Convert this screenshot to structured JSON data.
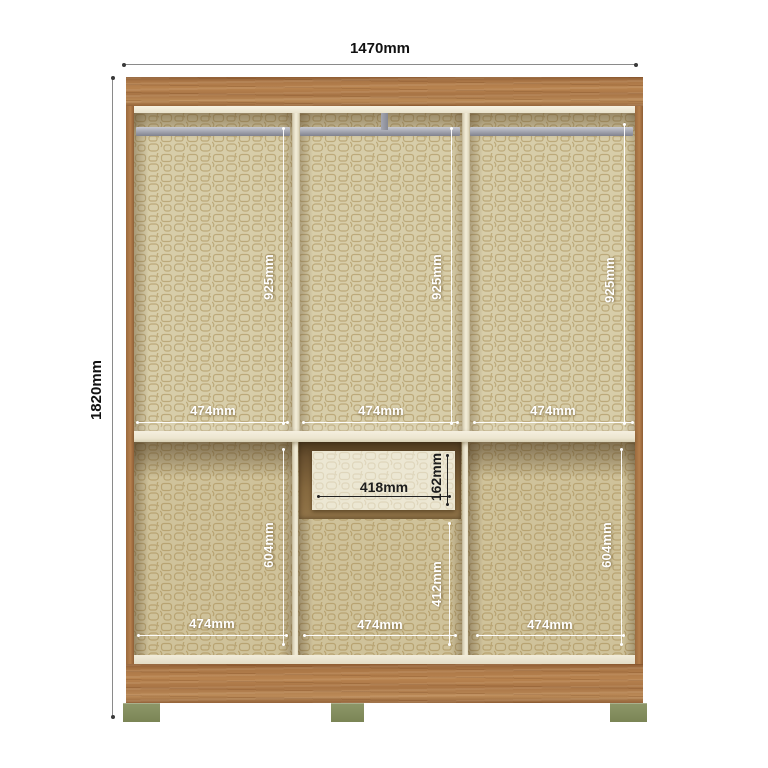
{
  "diagram": {
    "overall": {
      "width_label": "1470mm",
      "height_label": "1820mm"
    },
    "upper_sections": [
      {
        "width_label": "474mm",
        "height_label": "925mm"
      },
      {
        "width_label": "474mm",
        "height_label": "925mm"
      },
      {
        "width_label": "474mm",
        "height_label": "925mm"
      }
    ],
    "drawer": {
      "width_label": "418mm",
      "height_label": "162mm"
    },
    "lower_sections": [
      {
        "width_label": "474mm",
        "height_label": "604mm"
      },
      {
        "width_label": "474mm",
        "height_label": "412mm"
      },
      {
        "width_label": "474mm",
        "height_label": "604mm"
      }
    ],
    "colors": {
      "wood": "#b0824f",
      "interior_base": "#d7cda9",
      "pattern_line": "#b5a06c",
      "trim": "#f3eddb",
      "hanging_rail": "#a7a9b4",
      "feet": "#86915f",
      "drawer_recess": "#6a5130",
      "drawer_face": "#ece5cf",
      "dimension_outer": "#333333",
      "dimension_inner": "#ffffff"
    }
  }
}
